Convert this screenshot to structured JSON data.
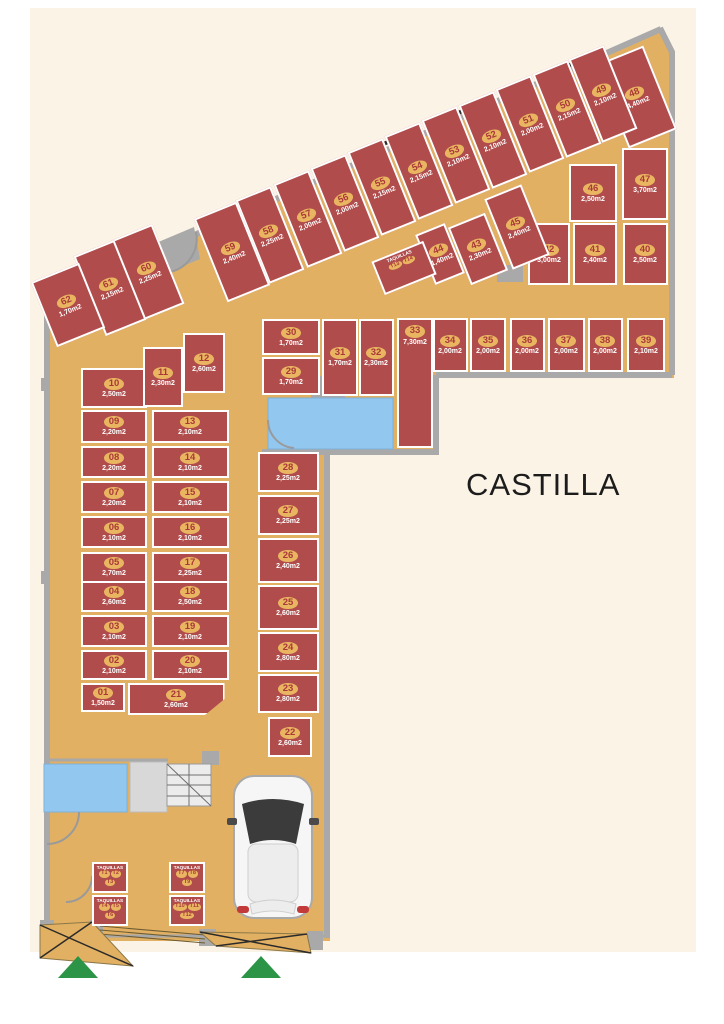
{
  "title": "CASTILLA",
  "palette": {
    "cream": "#fbf3e6",
    "floor": "#e2b062",
    "unit": "#b04c4c",
    "badge": "#eab561",
    "numred": "#a93939",
    "wall": "#a9a9a9",
    "blue": "#92c7ef",
    "green": "#2c9447"
  },
  "units": [
    {
      "id": "01",
      "area": "1,50m2",
      "x": 103,
      "y": 697,
      "w": 44,
      "h": 29,
      "r": 0
    },
    {
      "id": "02",
      "area": "2,10m2",
      "x": 114,
      "y": 665,
      "w": 66,
      "h": 30,
      "r": 0
    },
    {
      "id": "03",
      "area": "2,10m2",
      "x": 114,
      "y": 631,
      "w": 66,
      "h": 32,
      "r": 0
    },
    {
      "id": "04",
      "area": "2,60m2",
      "x": 114,
      "y": 596,
      "w": 66,
      "h": 31,
      "r": 0
    },
    {
      "id": "05",
      "area": "2,70m2",
      "x": 114,
      "y": 567,
      "w": 66,
      "h": 31,
      "r": 0
    },
    {
      "id": "06",
      "area": "2,10m2",
      "x": 114,
      "y": 532,
      "w": 66,
      "h": 32,
      "r": 0
    },
    {
      "id": "07",
      "area": "2,20m2",
      "x": 114,
      "y": 497,
      "w": 66,
      "h": 32,
      "r": 0
    },
    {
      "id": "08",
      "area": "2,20m2",
      "x": 114,
      "y": 462,
      "w": 66,
      "h": 32,
      "r": 0
    },
    {
      "id": "09",
      "area": "2,20m2",
      "x": 114,
      "y": 426,
      "w": 66,
      "h": 33,
      "r": 0
    },
    {
      "id": "10",
      "area": "2,50m2",
      "x": 114,
      "y": 388,
      "w": 66,
      "h": 40,
      "r": 0
    },
    {
      "id": "11",
      "area": "2,30m2",
      "x": 163,
      "y": 377,
      "w": 40,
      "h": 60,
      "r": 0
    },
    {
      "id": "12",
      "area": "2,60m2",
      "x": 204,
      "y": 363,
      "w": 42,
      "h": 60,
      "r": 0
    },
    {
      "id": "13",
      "area": "2,10m2",
      "x": 190,
      "y": 426,
      "w": 77,
      "h": 33,
      "r": 0
    },
    {
      "id": "14",
      "area": "2,10m2",
      "x": 190,
      "y": 462,
      "w": 77,
      "h": 32,
      "r": 0
    },
    {
      "id": "15",
      "area": "2,10m2",
      "x": 190,
      "y": 497,
      "w": 77,
      "h": 32,
      "r": 0
    },
    {
      "id": "16",
      "area": "2,10m2",
      "x": 190,
      "y": 532,
      "w": 77,
      "h": 32,
      "r": 0
    },
    {
      "id": "17",
      "area": "2,25m2",
      "x": 190,
      "y": 567,
      "w": 77,
      "h": 31,
      "r": 0
    },
    {
      "id": "18",
      "area": "2,50m2",
      "x": 190,
      "y": 596,
      "w": 77,
      "h": 31,
      "r": 0
    },
    {
      "id": "19",
      "area": "2,10m2",
      "x": 190,
      "y": 631,
      "w": 77,
      "h": 32,
      "r": 0
    },
    {
      "id": "20",
      "area": "2,10m2",
      "x": 190,
      "y": 665,
      "w": 77,
      "h": 30,
      "r": 0
    },
    {
      "id": "21",
      "area": "2,60m2",
      "x": 176,
      "y": 699,
      "w": 97,
      "h": 32,
      "r": 0,
      "cut": true
    },
    {
      "id": "22",
      "area": "2,60m2",
      "x": 290,
      "y": 737,
      "w": 44,
      "h": 40,
      "r": 0
    },
    {
      "id": "23",
      "area": "2,80m2",
      "x": 288,
      "y": 693,
      "w": 61,
      "h": 39,
      "r": 0
    },
    {
      "id": "24",
      "area": "2,80m2",
      "x": 288,
      "y": 652,
      "w": 61,
      "h": 40,
      "r": 0
    },
    {
      "id": "25",
      "area": "2,60m2",
      "x": 288,
      "y": 607,
      "w": 61,
      "h": 45,
      "r": 0
    },
    {
      "id": "26",
      "area": "2,40m2",
      "x": 288,
      "y": 560,
      "w": 61,
      "h": 45,
      "r": 0
    },
    {
      "id": "27",
      "area": "2,25m2",
      "x": 288,
      "y": 515,
      "w": 61,
      "h": 40,
      "r": 0
    },
    {
      "id": "28",
      "area": "2,25m2",
      "x": 288,
      "y": 472,
      "w": 61,
      "h": 40,
      "r": 0
    },
    {
      "id": "29",
      "area": "1,70m2",
      "x": 291,
      "y": 376,
      "w": 58,
      "h": 38,
      "r": 0
    },
    {
      "id": "30",
      "area": "1,70m2",
      "x": 291,
      "y": 337,
      "w": 58,
      "h": 36,
      "r": 0
    },
    {
      "id": "31",
      "area": "1,70m2",
      "x": 340,
      "y": 357,
      "w": 36,
      "h": 77,
      "r": 0
    },
    {
      "id": "32",
      "area": "2,30m2",
      "x": 376,
      "y": 357,
      "w": 35,
      "h": 77,
      "r": 0
    },
    {
      "id": "33",
      "area": "7,30m2",
      "x": 415,
      "y": 383,
      "w": 36,
      "h": 130,
      "r": 0,
      "align": "top"
    },
    {
      "id": "34",
      "area": "2,00m2",
      "x": 450,
      "y": 345,
      "w": 35,
      "h": 54,
      "r": 0
    },
    {
      "id": "35",
      "area": "2,00m2",
      "x": 488,
      "y": 345,
      "w": 36,
      "h": 54,
      "r": 0
    },
    {
      "id": "36",
      "area": "2,00m2",
      "x": 527,
      "y": 345,
      "w": 35,
      "h": 54,
      "r": 0
    },
    {
      "id": "37",
      "area": "2,00m2",
      "x": 566,
      "y": 345,
      "w": 37,
      "h": 54,
      "r": 0
    },
    {
      "id": "38",
      "area": "2,00m2",
      "x": 605,
      "y": 345,
      "w": 35,
      "h": 54,
      "r": 0
    },
    {
      "id": "39",
      "area": "2,10m2",
      "x": 646,
      "y": 345,
      "w": 38,
      "h": 54,
      "r": 0
    },
    {
      "id": "40",
      "area": "2,50m2",
      "x": 645,
      "y": 254,
      "w": 45,
      "h": 62,
      "r": 0
    },
    {
      "id": "41",
      "area": "2,40m2",
      "x": 595,
      "y": 254,
      "w": 44,
      "h": 62,
      "r": 0
    },
    {
      "id": "42",
      "area": "3,00m2",
      "x": 549,
      "y": 254,
      "w": 42,
      "h": 62,
      "r": 0
    },
    {
      "id": "43",
      "area": "2,30m2",
      "x": 478,
      "y": 249,
      "w": 40,
      "h": 62,
      "r": -22
    },
    {
      "id": "44",
      "area": "1,40m2",
      "x": 440,
      "y": 254,
      "w": 32,
      "h": 54,
      "r": -22
    },
    {
      "id": "45",
      "area": "2,40m2",
      "x": 517,
      "y": 227,
      "w": 40,
      "h": 76,
      "r": -22
    },
    {
      "id": "46",
      "area": "2,50m2",
      "x": 593,
      "y": 193,
      "w": 48,
      "h": 58,
      "r": 0
    },
    {
      "id": "47",
      "area": "3,70m2",
      "x": 645,
      "y": 184,
      "w": 46,
      "h": 72,
      "r": 0
    },
    {
      "id": "48",
      "area": "4,40m2",
      "x": 636,
      "y": 97,
      "w": 52,
      "h": 90,
      "r": -22
    },
    {
      "id": "49",
      "area": "2,10m2",
      "x": 603,
      "y": 94,
      "w": 38,
      "h": 90,
      "r": -22
    },
    {
      "id": "50",
      "area": "2,15m2",
      "x": 567,
      "y": 109,
      "w": 38,
      "h": 90,
      "r": -22
    },
    {
      "id": "51",
      "area": "2,00m2",
      "x": 530,
      "y": 124,
      "w": 38,
      "h": 90,
      "r": -22
    },
    {
      "id": "52",
      "area": "2,10m2",
      "x": 493,
      "y": 140,
      "w": 38,
      "h": 90,
      "r": -22
    },
    {
      "id": "53",
      "area": "2,10m2",
      "x": 456,
      "y": 155,
      "w": 38,
      "h": 90,
      "r": -22
    },
    {
      "id": "54",
      "area": "2,15m2",
      "x": 419,
      "y": 171,
      "w": 38,
      "h": 90,
      "r": -22
    },
    {
      "id": "55",
      "area": "2,15m2",
      "x": 382,
      "y": 187,
      "w": 38,
      "h": 90,
      "r": -22
    },
    {
      "id": "56",
      "area": "2,00m2",
      "x": 345,
      "y": 203,
      "w": 38,
      "h": 90,
      "r": -22
    },
    {
      "id": "57",
      "area": "2,00m2",
      "x": 308,
      "y": 219,
      "w": 38,
      "h": 90,
      "r": -22
    },
    {
      "id": "58",
      "area": "2,25m2",
      "x": 270,
      "y": 235,
      "w": 38,
      "h": 90,
      "r": -22
    },
    {
      "id": "59",
      "area": "2,40m2",
      "x": 232,
      "y": 252,
      "w": 46,
      "h": 90,
      "r": -22
    },
    {
      "id": "60",
      "area": "2,25m2",
      "x": 148,
      "y": 272,
      "w": 44,
      "h": 86,
      "r": -22
    },
    {
      "id": "61",
      "area": "2,15m2",
      "x": 110,
      "y": 288,
      "w": 44,
      "h": 86,
      "r": -22
    },
    {
      "id": "62",
      "area": "1,70m2",
      "x": 68,
      "y": 305,
      "w": 52,
      "h": 70,
      "r": -22
    }
  ],
  "taquillas": [
    {
      "label": "TAQUILLAS",
      "tags": [
        "T13",
        "T14"
      ],
      "x": 404,
      "y": 268,
      "w": 56,
      "h": 36,
      "r": -22
    },
    {
      "label": "TAQUILLAS",
      "tags": [
        "T1",
        "T2",
        "T3"
      ],
      "x": 110,
      "y": 877,
      "w": 36,
      "h": 31,
      "r": 0
    },
    {
      "label": "TAQUILLAS",
      "tags": [
        "T4",
        "T5",
        "T6"
      ],
      "x": 110,
      "y": 910,
      "w": 36,
      "h": 31,
      "r": 0
    },
    {
      "label": "TAQUILLAS",
      "tags": [
        "T7",
        "T8",
        "T9"
      ],
      "x": 187,
      "y": 877,
      "w": 36,
      "h": 31,
      "r": 0
    },
    {
      "label": "TAQUILLAS",
      "tags": [
        "T10",
        "T11",
        "T12"
      ],
      "x": 187,
      "y": 910,
      "w": 36,
      "h": 31,
      "r": 0
    }
  ]
}
